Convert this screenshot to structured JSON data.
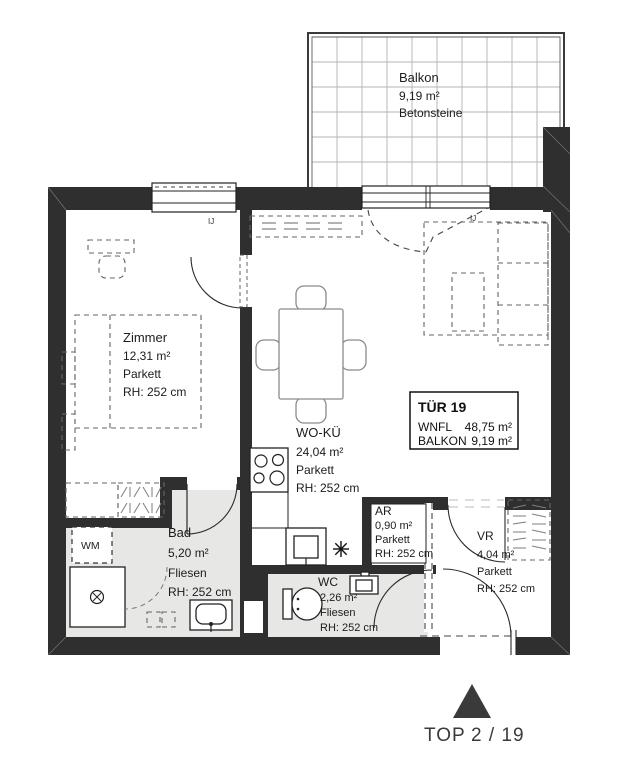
{
  "rooms": {
    "balkon": {
      "name": "Balkon",
      "area": "9,19 m²",
      "floor": "Betonsteine"
    },
    "zimmer": {
      "name": "Zimmer",
      "area": "12,31 m²",
      "floor": "Parkett",
      "height": "RH: 252 cm"
    },
    "woku": {
      "name": "WO-KÜ",
      "area": "24,04 m²",
      "floor": "Parkett",
      "height": "RH: 252 cm"
    },
    "bad": {
      "name": "Bad",
      "area": "5,20 m²",
      "floor": "Fliesen",
      "height": "RH: 252 cm"
    },
    "wc": {
      "name": "WC",
      "area": "2,26 m²",
      "floor": "Fliesen",
      "height": "RH: 252 cm"
    },
    "ar": {
      "name": "AR",
      "area": "0,90 m²",
      "floor": "Parkett",
      "height": "RH: 252 cm"
    },
    "vr": {
      "name": "VR",
      "area": "4,04 m²",
      "floor": "Parkett",
      "height": "RH: 252 cm"
    }
  },
  "info_box": {
    "title": "TÜR 19",
    "rows": [
      {
        "label": "WNFL",
        "value": "48,75 m²"
      },
      {
        "label": "BALKON",
        "value": "9,19 m²"
      }
    ]
  },
  "labels": {
    "wm": "WM",
    "window_code": "IJ"
  },
  "footer": {
    "top_label": "TOP",
    "unit_number": "2 / 19"
  },
  "colors": {
    "wall": "#2f2f2f",
    "tile_floor": "#e7e7e5",
    "background": "#ffffff"
  }
}
